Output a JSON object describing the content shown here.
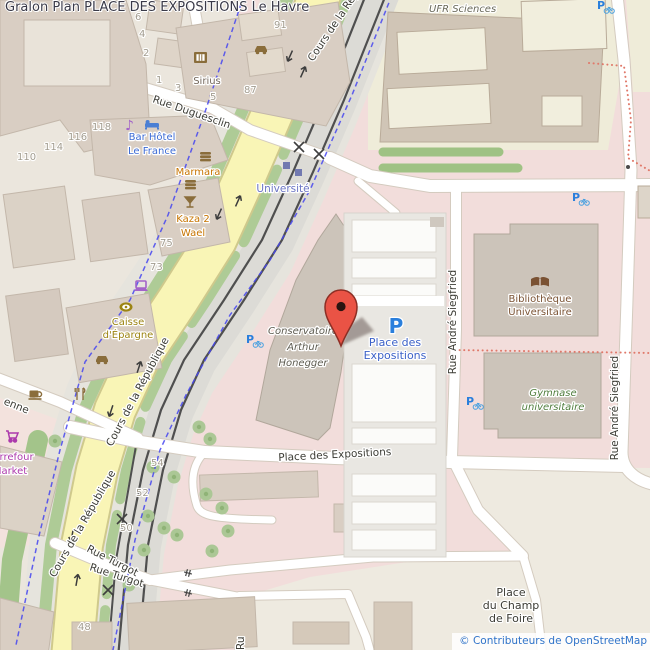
{
  "header": {
    "title": "Gralon Plan PLACE DES EXPOSITIONS Le Havre"
  },
  "attribution": {
    "text": "© Contributeurs de OpenStreetMap"
  },
  "map": {
    "streets": {
      "cours_top": "Cours de la République",
      "cours_mid": "Cours de la République",
      "cours_bottom": "Cours de la République",
      "duguesclin": "Rue Duguesclin",
      "turgot_1": "Rue Turgot",
      "turgot_2": "Rue Turgot",
      "siegfried_left": "Rue André Siegfried",
      "siegfried_right": "Rue André Siegfried",
      "place_des_expositions": "Place des Expositions",
      "enne": "enne",
      "ru_fragment": "Ru"
    },
    "places": {
      "universite": "Université",
      "champ_de_foire": [
        "Place",
        "du Champ",
        "de Foire"
      ]
    },
    "pois": {
      "sirius": "Sirius",
      "bar_hotel": [
        "Bar Hôtel",
        "Le France"
      ],
      "marmara": "Marmara",
      "kaza": [
        "Kaza 2",
        "Wael"
      ],
      "caisse": [
        "Caisse",
        "d'Épargne"
      ],
      "carrefour": [
        "Carrefour",
        "Market"
      ],
      "conservatoire": [
        "Conservatoire",
        "Arthur",
        "Honegger"
      ],
      "ufr": "UFR Sciences",
      "bibliotheque": [
        "Bibliothèque",
        "Universitaire"
      ],
      "gymnase": [
        "Gymnase",
        "universitaire"
      ]
    },
    "parking": {
      "p": "P",
      "label": [
        "Place des",
        "Expositions"
      ]
    },
    "house_numbers": [
      "91",
      "87",
      "5",
      "3",
      "1",
      "2",
      "4",
      "6",
      "118",
      "116",
      "114",
      "110",
      "75",
      "73",
      "54",
      "52",
      "50",
      "48"
    ],
    "icons": {
      "p_letter": "P",
      "music_note_glyph": "♪",
      "names": [
        "map-pin-icon",
        "parking-icon",
        "bicycle-parking-icon",
        "hotel-bed-icon",
        "music-note-icon",
        "cinema-film-icon",
        "restaurant-burger-icon",
        "bar-cocktail-icon",
        "cafe-cup-icon",
        "restaurant-cutlery-icon",
        "car-icon",
        "bank-coin-icon",
        "computer-laptop-icon",
        "supermarket-cart-icon",
        "library-book-icon",
        "tram-stop-icon",
        "level-crossing-icon",
        "gate-icon",
        "tree-icon",
        "oneway-arrow-icon"
      ]
    },
    "colors": {
      "road_yellow": "#f9f5b6",
      "green_strip": "#aecb96",
      "pink_area": "#f2dddb",
      "beige_area": "#ebe6dd",
      "education_area": "#efecd9",
      "building": "#d9cec3",
      "building_dark": "#ccc4ba",
      "rail": "#4f4f4f",
      "cycleway_blue": "#4646f0",
      "path_red": "#e0796a",
      "parking_blue": "#2a7fdc",
      "hotel_blue": "#3b6ad4",
      "restaurant_orange": "#c77400",
      "bank_olive": "#9c8413",
      "supermarket_purple": "#ac39ac",
      "library_brown": "#7a5233",
      "leisure_green": "#4f7d3d",
      "marker_red": "#ea5345",
      "attribution_blue": "#2f73c9"
    }
  }
}
